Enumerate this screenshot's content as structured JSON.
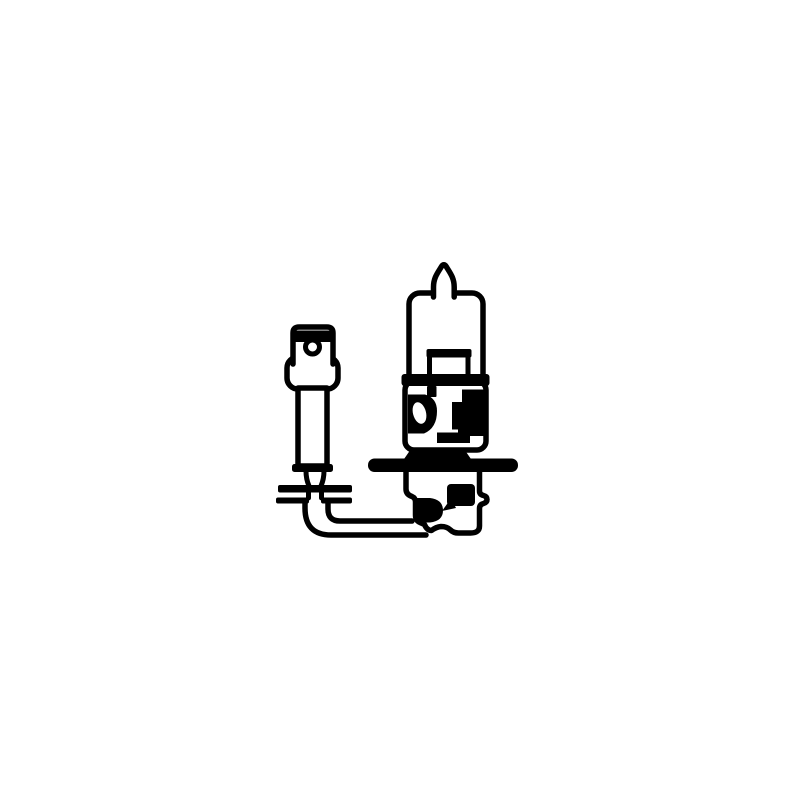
{
  "page": {
    "title": "H3 halogen bulb line drawing",
    "background_color": "#ffffff"
  },
  "illustration": {
    "title": "H3 halogen bulb with flat spade connector",
    "aria_label": "Black and white technical line drawing of an H3 halogen bulb with mounting flange, wire lead and flat spade terminal connector",
    "ink_color": "#000000",
    "paper_color": "#ffffff",
    "parts": [
      {
        "id": "sealing-tip",
        "label": "glass sealing tip"
      },
      {
        "id": "glass-envelope",
        "label": "glass envelope"
      },
      {
        "id": "filament-mount",
        "label": "filament mount"
      },
      {
        "id": "metal-base",
        "label": "metal base collar"
      },
      {
        "id": "mounting-flange",
        "label": "mounting flange disc"
      },
      {
        "id": "base-lower-shell",
        "label": "base lower shell"
      },
      {
        "id": "wire-lead",
        "label": "wire lead with elbow"
      },
      {
        "id": "wire-crimp",
        "label": "wire crimp sleeve"
      },
      {
        "id": "spade-terminal",
        "label": "flat spade terminal"
      },
      {
        "id": "terminal-hole",
        "label": "terminal locating hole"
      }
    ]
  }
}
